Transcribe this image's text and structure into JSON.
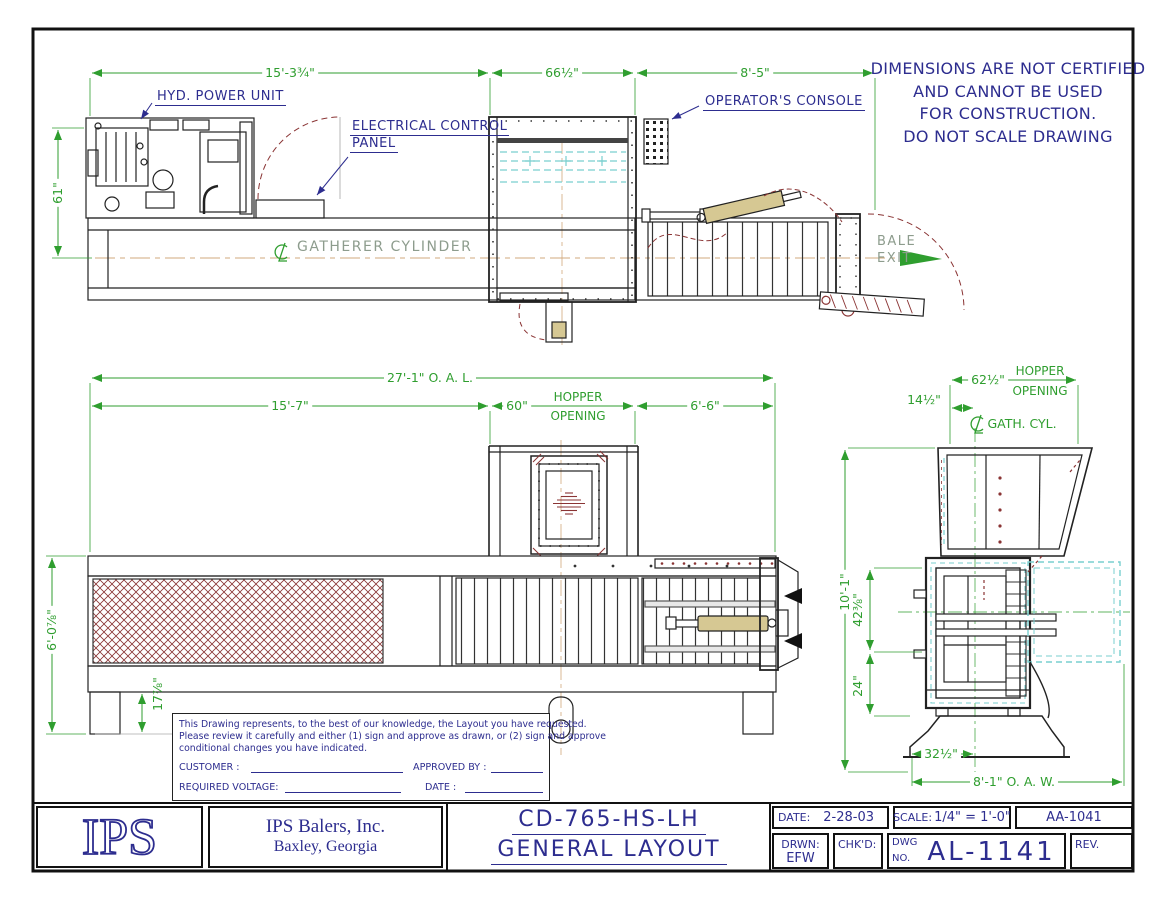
{
  "disclaimer": {
    "line1": "DIMENSIONS ARE NOT CERTIFIED",
    "line2": "AND CANNOT BE USED",
    "line3": "FOR CONSTRUCTION.",
    "line4": "DO NOT SCALE DRAWING"
  },
  "plan": {
    "hyd_power_unit": "HYD. POWER UNIT",
    "electrical_control_line1": "ELECTRICAL CONTROL",
    "electrical_control_line2": "PANEL",
    "operators_console": "OPERATOR'S CONSOLE",
    "gatherer_cylinder": "GATHERER CYLINDER",
    "bale_line1": "BALE",
    "bale_line2": "EXIT",
    "dim_left": "15'-3¾\"",
    "dim_mid": "66½\"",
    "dim_right": "8'-5\"",
    "dim_height": "61\""
  },
  "elevation": {
    "dim_oal": "27'-1\" O. A. L.",
    "dim_left": "15'-7\"",
    "dim_hopper_val": "60\"",
    "hopper_word1": "HOPPER",
    "hopper_word2": "OPENING",
    "dim_right": "6'-6\"",
    "dim_height": "6'-0⅞\"",
    "dim_leg": "17⅞\""
  },
  "end_view": {
    "dim_hopper": "62½\"",
    "hopper_word1": "HOPPER",
    "hopper_word2": "OPENING",
    "dim_offset": "14½\"",
    "gath_cyl": "GATH. CYL.",
    "dim_height": "10'-1\"",
    "dim_mid": "42⅜\"",
    "dim_base": "24\"",
    "dim_pedestal": "32½\"",
    "dim_oaw": "8'-1\" O. A. W."
  },
  "notes": {
    "para1": "This Drawing represents, to the best of our knowledge, the Layout you have requested.",
    "para2": "Please review it carefully and either (1) sign and approve as drawn, or (2) sign and approve",
    "para3": "conditional changes you have indicated.",
    "customer_label": "CUSTOMER :",
    "approved_label": "APPROVED BY :",
    "voltage_label": "REQUIRED VOLTAGE:",
    "date_label": "DATE :"
  },
  "title_block": {
    "logo": "IPS",
    "company": "IPS Balers, Inc.",
    "location": "Baxley, Georgia",
    "model": "CD-765-HS-LH",
    "drawing_title": "GENERAL LAYOUT",
    "date_label": "DATE:",
    "date_value": "2-28-03",
    "scale_label": "SCALE:",
    "scale_value": "1/4\" = 1'-0\"",
    "sheet_code": "AA-1041",
    "drwn_label": "DRWN:",
    "drwn_value": "EFW",
    "chkd_label": "CHK'D:",
    "dwg_label_1": "DWG",
    "dwg_label_2": "NO.",
    "dwg_number": "AL-1141",
    "rev_label": "REV."
  },
  "colors": {
    "navy": "#2d2d8f",
    "dim_green": "#2f9e2f",
    "maroon": "#8a3434",
    "cyan": "#79cfcf",
    "tan": "#d6c893"
  }
}
